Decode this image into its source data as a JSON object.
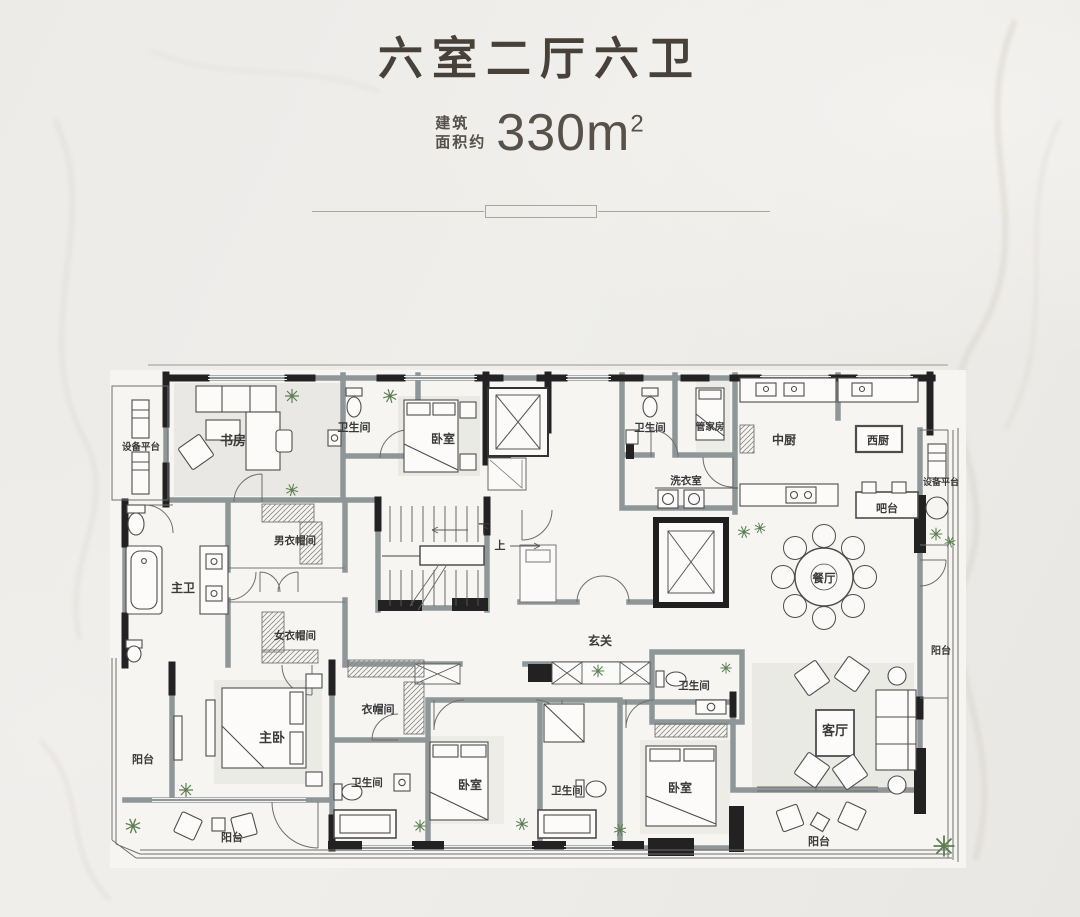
{
  "header": {
    "title": "六室二厅六卫",
    "area_label_line1": "建筑",
    "area_label_line2": "面积约",
    "area_value": "330m",
    "area_superscript": "2"
  },
  "colors": {
    "background": "#edebe8",
    "wall_dark": "#222222",
    "wall_gray": "#8f9697",
    "paper": "#f6f5f2",
    "plant_green": "#5c7f52",
    "title_text": "#474139",
    "divider": "#a9a59f"
  },
  "plan": {
    "labels": [
      {
        "text": "设备平台"
      },
      {
        "text": "书房"
      },
      {
        "text": "卫生间"
      },
      {
        "text": "卧室"
      },
      {
        "text": "卫生间"
      },
      {
        "text": "管家房"
      },
      {
        "text": "中厨"
      },
      {
        "text": "西厨"
      },
      {
        "text": "设备平台"
      },
      {
        "text": "洗衣室"
      },
      {
        "text": "吧台"
      },
      {
        "text": "男衣帽间"
      },
      {
        "text": "主卫"
      },
      {
        "text": "下"
      },
      {
        "text": "上"
      },
      {
        "text": "餐厅"
      },
      {
        "text": "女衣帽间"
      },
      {
        "text": "玄关"
      },
      {
        "text": "阳台"
      },
      {
        "text": "衣帽间"
      },
      {
        "text": "卫生间"
      },
      {
        "text": "主卧"
      },
      {
        "text": "阳台"
      },
      {
        "text": "卫生间"
      },
      {
        "text": "卧室"
      },
      {
        "text": "卫生间"
      },
      {
        "text": "卧室"
      },
      {
        "text": "客厅"
      },
      {
        "text": "阳台"
      },
      {
        "text": "阳台"
      }
    ]
  }
}
